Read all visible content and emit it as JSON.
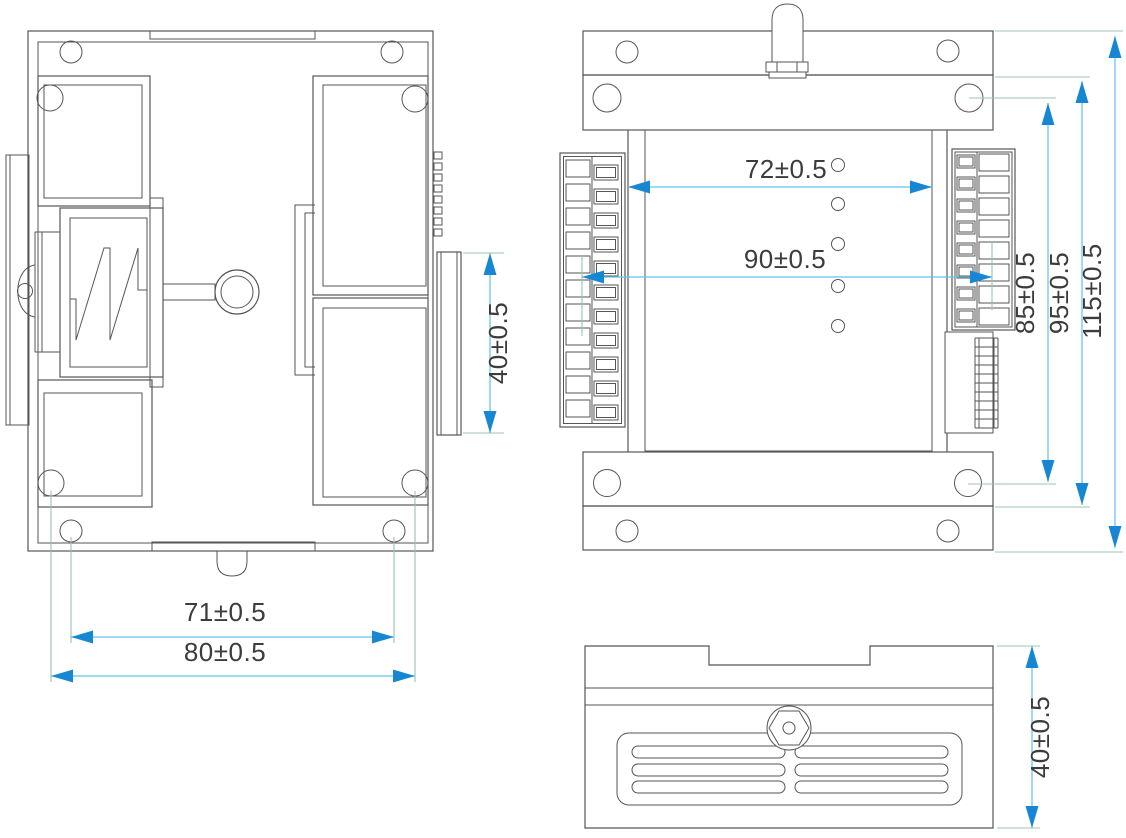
{
  "drawing": {
    "type": "mechanical-dimension-drawing",
    "colors": {
      "background": "#ffffff",
      "line": "#565656",
      "dim_line": "#62c2e9",
      "arrow": "#1787d3",
      "extension_line": "#9cc4b2",
      "text": "#3c3c3c"
    },
    "views": {
      "side": {
        "name": "side-view",
        "dim_screw_span": "71±0.5",
        "dim_overall_width": "80±0.5",
        "dim_connector_height": "40±0.5",
        "fin_count": 8
      },
      "front": {
        "name": "front-view",
        "dim_body_width": "72±0.5",
        "dim_terminal_span": "90±0.5",
        "dim_screw_height": "85±0.5",
        "dim_flange_height": "95±0.5",
        "dim_overall_height": "115±0.5",
        "led_count": 5,
        "left_terminal_rows": 11,
        "right_terminal_rows": 8,
        "dip_segments": 10
      },
      "bottom": {
        "name": "bottom-view",
        "dim_depth": "40±0.5",
        "vent_rows": 3,
        "vent_columns": 2
      }
    }
  }
}
